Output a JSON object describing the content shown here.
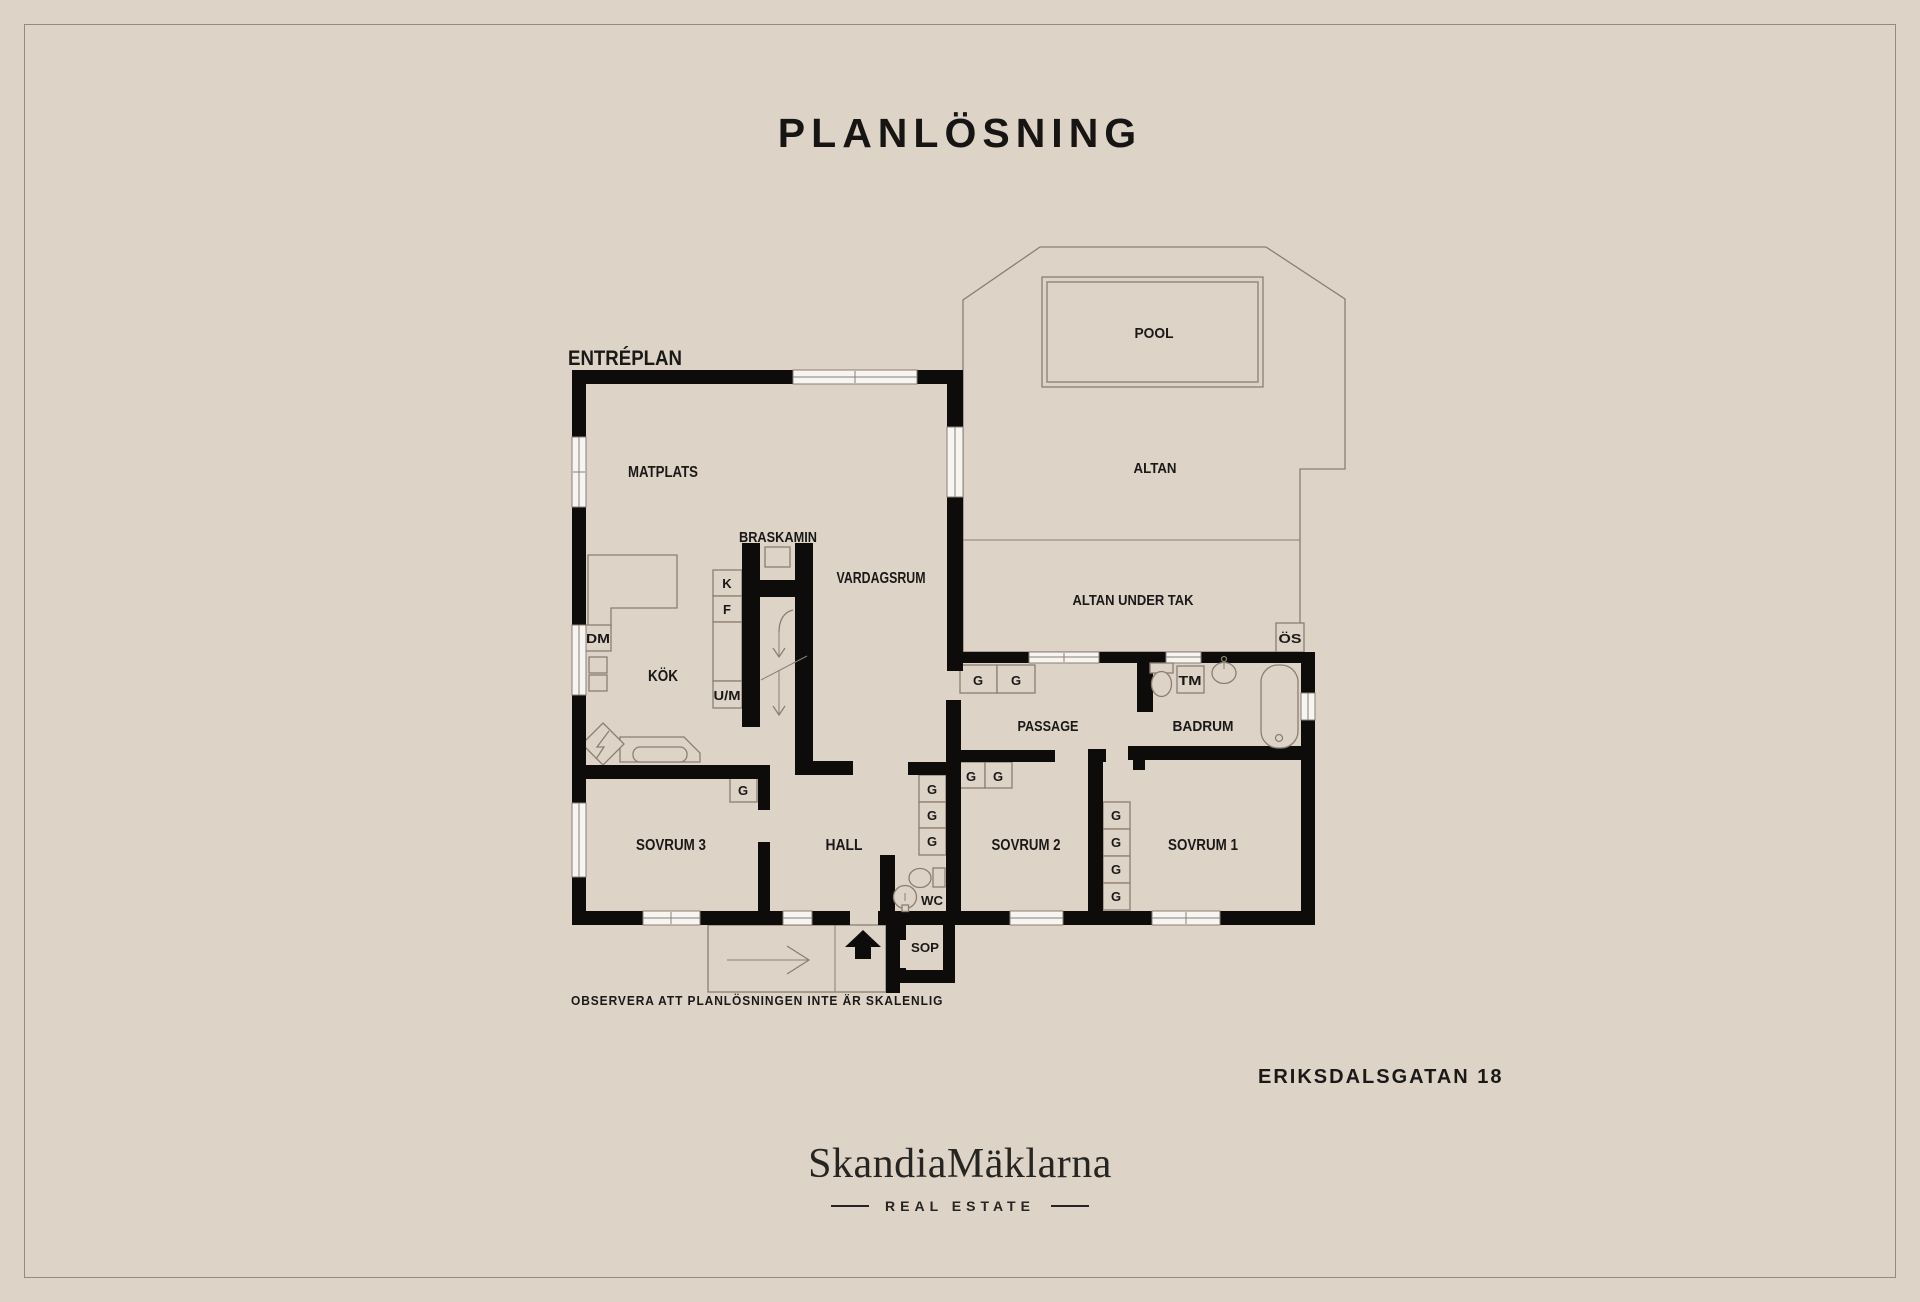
{
  "page": {
    "title": "PLANLÖSNING",
    "background_color": "#ddd3c7",
    "wall_color": "#0d0c0b",
    "line_color": "#8b7f72",
    "footer": {
      "disclaimer": "OBSERVERA ATT PLANLÖSNINGEN INTE ÄR SKALENLIG",
      "address": "ERIKSDALSGATAN 18"
    },
    "brand": {
      "name": "SkandiaMäklarna",
      "tagline": "REAL ESTATE"
    }
  },
  "plan": {
    "floor_label": "ENTRÉPLAN",
    "rooms": {
      "matplats": "MATPLATS",
      "kok": "KÖK",
      "vardagsrum": "VARDAGSRUM",
      "braskamin": "BRASKAMIN",
      "hall": "HALL",
      "sovrum1": "SOVRUM 1",
      "sovrum2": "SOVRUM 2",
      "sovrum3": "SOVRUM 3",
      "passage": "PASSAGE",
      "badrum": "BADRUM",
      "wc": "WC",
      "sop": "SOP",
      "pool": "POOL",
      "altan": "ALTAN",
      "altan_under_tak": "ALTAN UNDER TAK"
    },
    "fixtures": {
      "k": "K",
      "f": "F",
      "um": "U/M",
      "dm": "DM",
      "tm": "TM",
      "os": "ÖS",
      "g": "G"
    }
  }
}
